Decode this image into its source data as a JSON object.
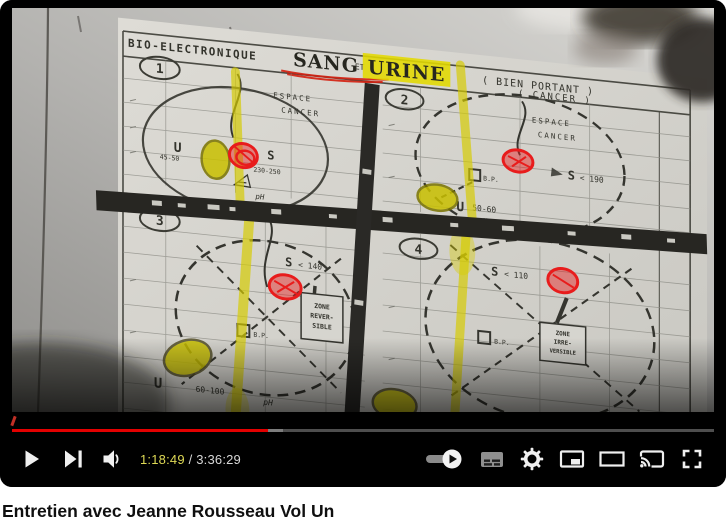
{
  "player": {
    "progress": {
      "played_percent": 36.4,
      "buffered_percent": 38.6
    },
    "time": {
      "current": "1:18:49",
      "separator": " / ",
      "duration": "3:36:29"
    },
    "icons": {
      "play": "play-icon",
      "next": "next-icon",
      "volume": "volume-icon",
      "autoplay": "autoplay-toggle",
      "subtitles": "subtitles-icon",
      "settings": "gear-icon",
      "miniplayer": "miniplayer-icon",
      "theater": "theater-icon",
      "cast": "cast-icon",
      "fullscreen": "fullscreen-icon"
    },
    "colors": {
      "progress_red": "#e30000",
      "time_current": "#ded955"
    }
  },
  "video": {
    "chart": {
      "header": {
        "label": "BIO-ELECTRONIQUE",
        "sang": "SANG",
        "et": "ET",
        "urine": "URINE",
        "bien_portant": "( BIEN PORTANT )",
        "cancer_line": "( CANCER )"
      },
      "q1": {
        "num": "1",
        "espace": "ESPACE",
        "cancer": "CANCER",
        "u": "U",
        "u_range": "45-50",
        "s": "S",
        "s_range": "230-250",
        "ph": "pH"
      },
      "q2": {
        "num": "2",
        "espace": "ESPACE",
        "cancer": "CANCER",
        "bp": "B.P.",
        "s": "S",
        "s_range": "< 190",
        "u": "U",
        "u_range": "50-60",
        "ph": "pH"
      },
      "q3": {
        "num": "3",
        "s": "S",
        "s_range": "< 140",
        "bp": "B.P.",
        "zone1": "ZONE",
        "zone2": "REVER-",
        "zone3": "SIBLE",
        "u": "U",
        "u_range": "60-100",
        "ph": "pH"
      },
      "q4": {
        "num": "4",
        "s": "S",
        "s_range": "< 110",
        "bp": "B.P.",
        "zone1": "ZONE",
        "zone2": "IRRE-",
        "zone3": "VERSIBLE"
      },
      "highlight_yellow": "#d6cc00",
      "marker_red": "#e81c1c"
    }
  },
  "below": {
    "title": "Entretien avec Jeanne Rousseau Vol Un"
  }
}
